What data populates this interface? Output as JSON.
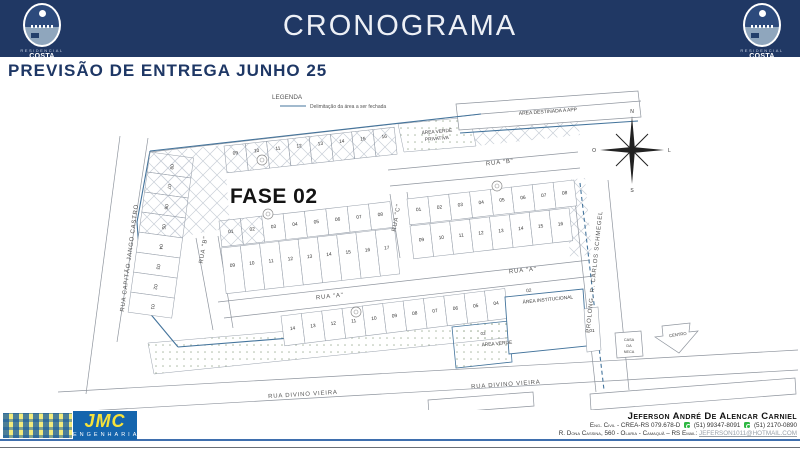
{
  "header": {
    "title": "CRONOGRAMA",
    "logo_top": "RESIDENCIAL",
    "logo_name": "COSTA NORTE"
  },
  "subtitle": "PREVISÃO DE ENTREGA JUNHO 25",
  "legend": {
    "title": "LEGENDA",
    "item": "Delimitação da área a ser fechada",
    "line_color": "#44749c"
  },
  "map": {
    "fase": "FASE 02",
    "areas": {
      "app": "ÁREA DESTINADA A APP",
      "avp1": "ÁREA VERDE",
      "avp2": "PRIVATIVA",
      "inst_num": "02",
      "inst": "ÁREA INSTITUCIONAL",
      "verde_num": "03",
      "verde": "ÁREA VERDE",
      "casa1": "CASA",
      "casa2": "DA",
      "casa3": "NECA",
      "centro": "CENTRO",
      "lot01": "01"
    },
    "streets": {
      "capitao": "RUA CAPITÃO JANGO CASTRO",
      "rua_a": "RUA \"A\"",
      "rua_b": "RUA \"B\"",
      "rua_c": "RUA \"C\"",
      "prolong": "PROLONG. R. CARLOS SCHMEGEL",
      "divino": "RUA DIVINO VIEIRA"
    },
    "compass": {
      "n": "N",
      "s": "S",
      "l": "L",
      "o": "O"
    },
    "lot_rows": [
      {
        "id": "top-row",
        "x": 224,
        "y": 146,
        "angle": -6.3,
        "w": 21.4,
        "h": 27,
        "numFrac": 0.3,
        "hatch": true,
        "numbers": [
          "09",
          "10",
          "11",
          "12",
          "13",
          "14",
          "15",
          "16"
        ]
      },
      {
        "id": "left-col",
        "x": 150,
        "y": 152,
        "angle": 97.8,
        "w": 20.2,
        "h": 44,
        "flip": true,
        "numFrac": 0.5,
        "hatch": [
          1,
          1,
          1,
          1,
          0,
          0,
          0,
          0
        ],
        "numbers": [
          "08",
          "07",
          "06",
          "05",
          "04",
          "03",
          "02",
          "01"
        ]
      },
      {
        "id": "c-top",
        "x": 219,
        "y": 221,
        "angle": -6.5,
        "w": 21.5,
        "h": 26,
        "numFrac": 0.45,
        "hatch": [
          1,
          1,
          0,
          0,
          0,
          0,
          0,
          0
        ],
        "numbers": [
          "01",
          "02",
          "03",
          "04",
          "05",
          "06",
          "07",
          "08"
        ]
      },
      {
        "id": "c-bottom",
        "x": 221,
        "y": 248,
        "angle": -6.5,
        "w": 19.4,
        "h": 46,
        "numFrac": 0.4,
        "numbers": [
          "09",
          "10",
          "11",
          "12",
          "13",
          "14",
          "15",
          "16",
          "17"
        ]
      },
      {
        "id": "d-top",
        "x": 407,
        "y": 199,
        "angle": -6.5,
        "w": 21,
        "h": 26,
        "numFrac": 0.45,
        "numbers": [
          "01",
          "02",
          "03",
          "04",
          "05",
          "06",
          "07",
          "08"
        ]
      },
      {
        "id": "d-bottom",
        "x": 410,
        "y": 226,
        "angle": -6.5,
        "w": 20,
        "h": 33,
        "numFrac": 0.45,
        "numbers": [
          "09",
          "10",
          "11",
          "12",
          "13",
          "14",
          "15",
          "16"
        ]
      },
      {
        "id": "e-row",
        "x": 281,
        "y": 316,
        "angle": -7,
        "w": 20.5,
        "h": 30,
        "numFrac": 0.45,
        "numbers": [
          "14",
          "13",
          "12",
          "11",
          "10",
          "09",
          "08",
          "07",
          "06",
          "05",
          "04"
        ]
      }
    ],
    "markers": [
      [
        262,
        160
      ],
      [
        268,
        214
      ],
      [
        497,
        186
      ],
      [
        356,
        312
      ]
    ]
  },
  "footer": {
    "logo_text": "JMC",
    "company": "ENGENHARIA",
    "engineer": "Jeferson André De Alencar Carniel",
    "cred": "Eng. Civil - CREA-RS 079.678-D",
    "phone1": "(51) 99347-8091",
    "phone2": "(51) 2170-0890",
    "address": "R. Dona Cassina, 560 - Olaria - Camaquã – RS",
    "email_label": "Email:",
    "email": "JEFERSON1011@HOTMAIL.COM"
  }
}
